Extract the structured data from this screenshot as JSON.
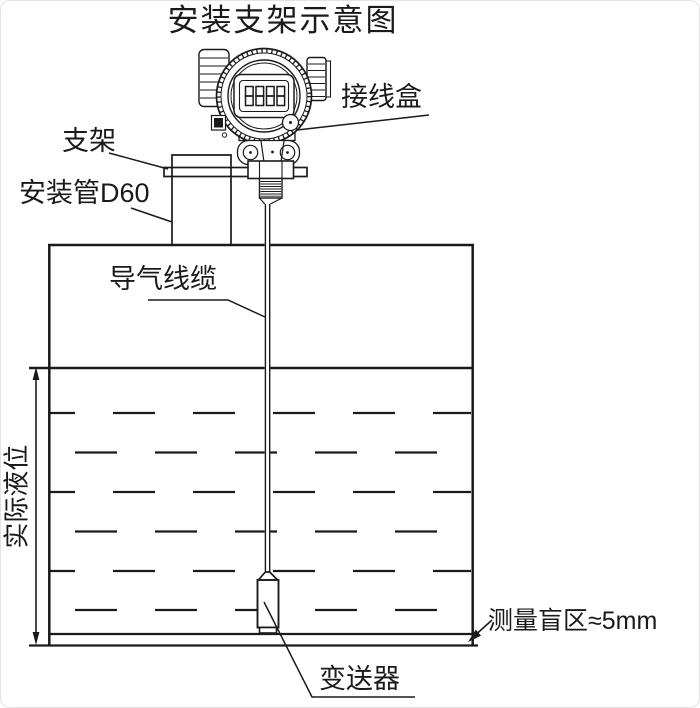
{
  "title": "安装支架示意图",
  "diagram": {
    "labels": {
      "junction_box": "接线盒",
      "bracket": "支架",
      "mounting_pipe": "安装管D60",
      "air_cable": "导气线缆",
      "actual_level": "实际液位",
      "blind_zone": "测量盲区≈5mm",
      "transmitter": "变送器"
    },
    "display_value": "8888",
    "colors": {
      "line": "#1a1a1a",
      "background": "#ffffff"
    }
  }
}
